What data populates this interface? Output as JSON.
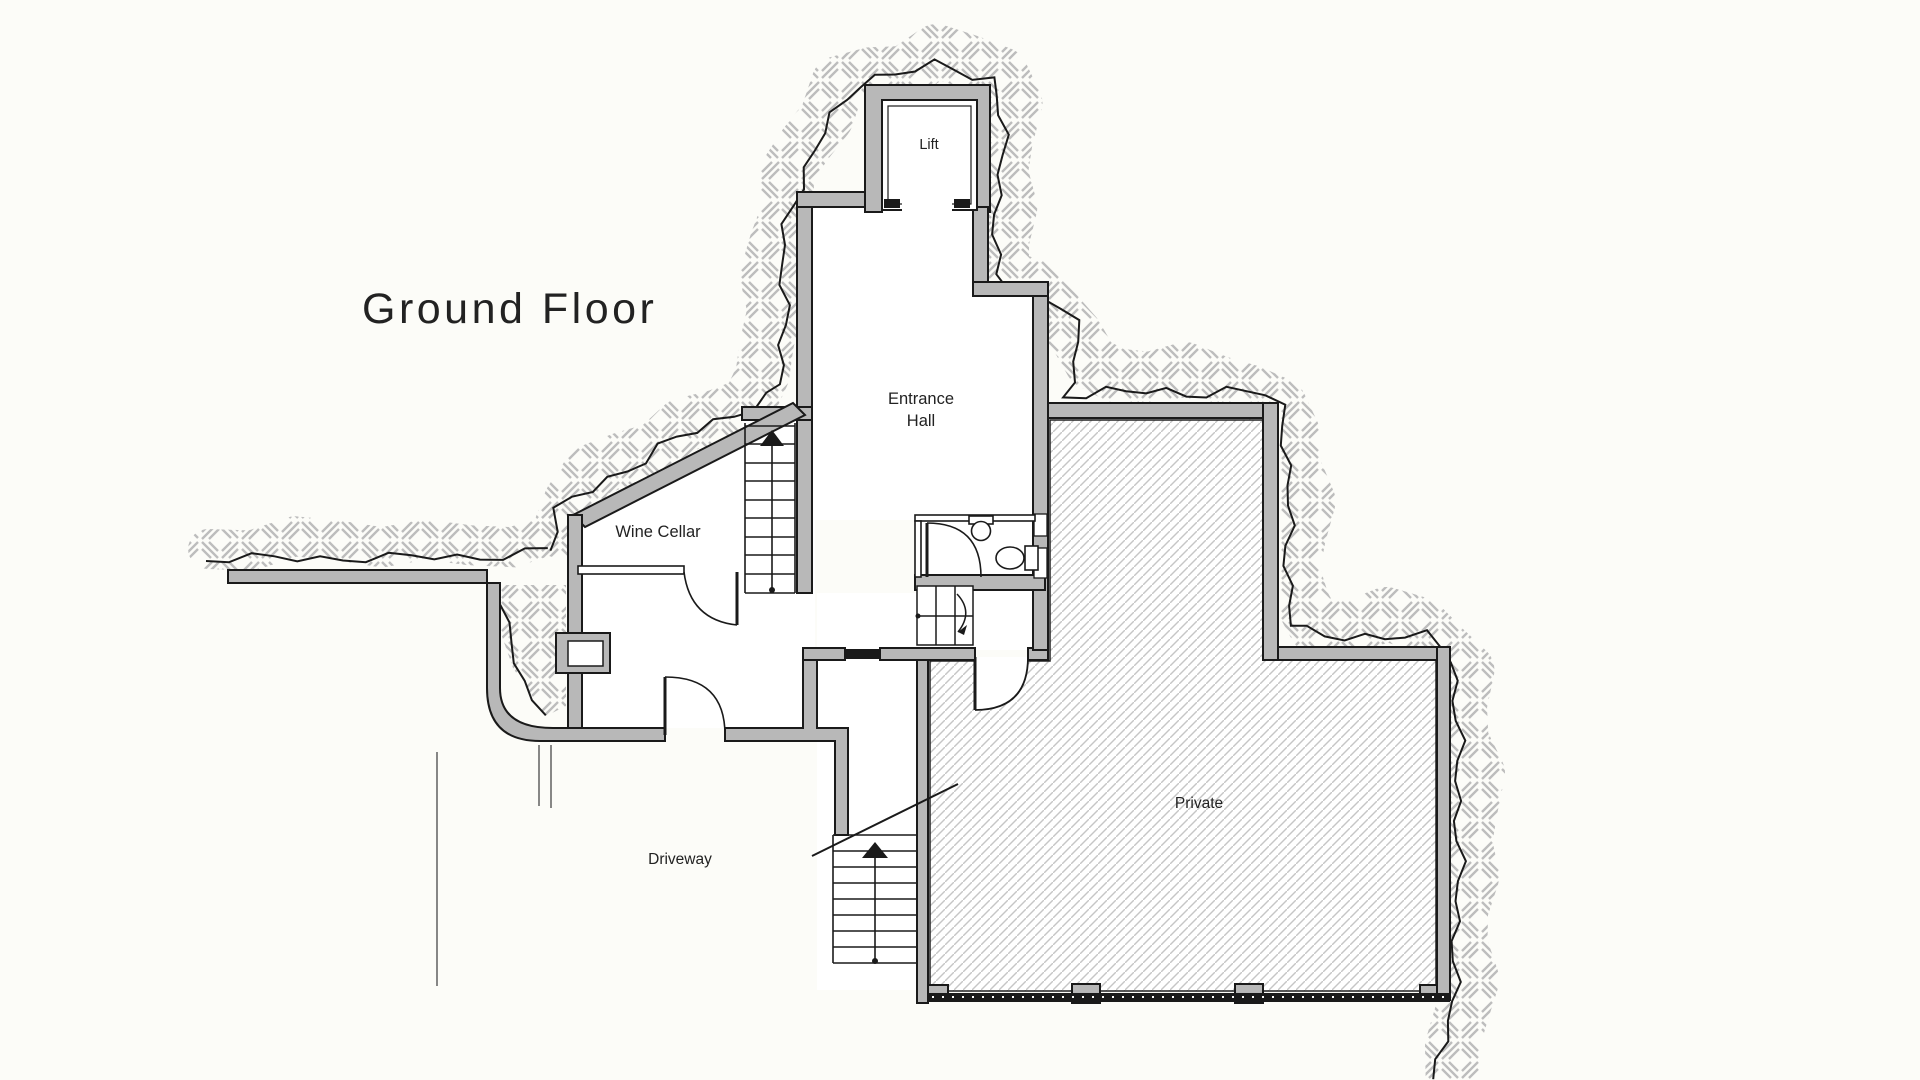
{
  "page": {
    "background": "#fcfcf8"
  },
  "plan": {
    "title": "Ground Floor",
    "bottom_title": "Ground Floor",
    "rooms": {
      "lift": "Lift",
      "entrance_hall": {
        "line1": "Entrance",
        "line2": "Hall"
      },
      "wine_cellar": "Wine Cellar",
      "driveway": "Driveway",
      "private": "Private"
    },
    "colors": {
      "background": "#fcfcf8",
      "wall_fill": "#b8b8b8",
      "outline": "#1a1a1a",
      "private_hatch_line": "#c6c6c6",
      "ground_weave_line": "#bdbdbd",
      "text": "#222222"
    }
  }
}
